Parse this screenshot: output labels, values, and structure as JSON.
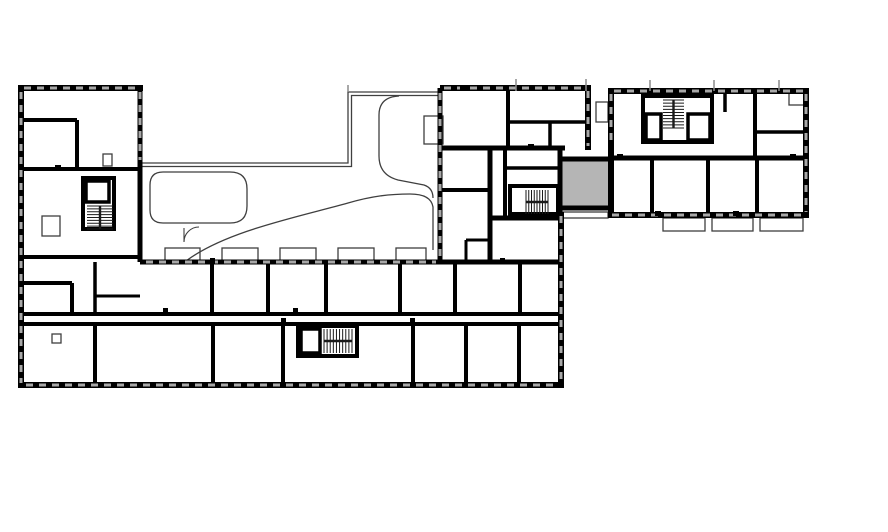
{
  "plan": {
    "canvas": {
      "w": 888,
      "h": 532
    },
    "background": "#ffffff",
    "colors": {
      "wall": "#000000",
      "thin": "#3f3f3f",
      "window": "#a8a8a8",
      "highlight_fill": "#b5b5b5",
      "tread": "#1a1a1a",
      "tick": "#8a8a8a"
    },
    "highlight": {
      "name": "selected-unit",
      "x": 562,
      "y": 161,
      "w": 47,
      "h": 46
    },
    "walls": [
      [
        18,
        88,
        143,
        88,
        6
      ],
      [
        21,
        85,
        21,
        388,
        6
      ],
      [
        18,
        385,
        564,
        385,
        6
      ],
      [
        561,
        212,
        561,
        385,
        6
      ],
      [
        140,
        88,
        140,
        262,
        5
      ],
      [
        440,
        88,
        591,
        88,
        6
      ],
      [
        440,
        88,
        440,
        264,
        5
      ],
      [
        588,
        88,
        588,
        150,
        6
      ],
      [
        440,
        148,
        565,
        148,
        5
      ],
      [
        560,
        148,
        560,
        214,
        5
      ],
      [
        558,
        159,
        614,
        159,
        5
      ],
      [
        560,
        208,
        614,
        208,
        5
      ],
      [
        488,
        218,
        562,
        218,
        5
      ],
      [
        490,
        148,
        490,
        264,
        5
      ],
      [
        611,
        91,
        809,
        91,
        6
      ],
      [
        806,
        88,
        806,
        218,
        6
      ],
      [
        608,
        215,
        809,
        215,
        6
      ],
      [
        611,
        88,
        611,
        218,
        6
      ],
      [
        140,
        262,
        561,
        262,
        5
      ],
      [
        18,
        314,
        561,
        314,
        4
      ],
      [
        18,
        324,
        561,
        324,
        4
      ],
      [
        20,
        120,
        77,
        120,
        4
      ],
      [
        77,
        120,
        77,
        171,
        4
      ],
      [
        20,
        169,
        142,
        169,
        4
      ],
      [
        20,
        257,
        142,
        257,
        4
      ],
      [
        20,
        283,
        72,
        283,
        4
      ],
      [
        72,
        283,
        72,
        316,
        4
      ],
      [
        508,
        88,
        508,
        148,
        4
      ],
      [
        508,
        122,
        588,
        122,
        3.5
      ],
      [
        550,
        122,
        550,
        148,
        3.5
      ],
      [
        440,
        190,
        490,
        190,
        4
      ],
      [
        466,
        240,
        490,
        240,
        3
      ],
      [
        466,
        240,
        466,
        262,
        3
      ],
      [
        505,
        148,
        505,
        220,
        4
      ],
      [
        505,
        168,
        560,
        168,
        3.5
      ],
      [
        95,
        262,
        95,
        316,
        3.5
      ],
      [
        95,
        296,
        140,
        296,
        3
      ],
      [
        212,
        262,
        212,
        314,
        4
      ],
      [
        268,
        262,
        268,
        314,
        4
      ],
      [
        326,
        262,
        326,
        314,
        4
      ],
      [
        400,
        262,
        400,
        314,
        4
      ],
      [
        455,
        262,
        455,
        314,
        4
      ],
      [
        520,
        262,
        520,
        314,
        4
      ],
      [
        95,
        324,
        95,
        385,
        4
      ],
      [
        213,
        324,
        213,
        385,
        4
      ],
      [
        283,
        324,
        283,
        385,
        4
      ],
      [
        413,
        324,
        413,
        385,
        4
      ],
      [
        466,
        324,
        466,
        385,
        4
      ],
      [
        519,
        324,
        519,
        385,
        4
      ],
      [
        611,
        158,
        806,
        158,
        5
      ],
      [
        755,
        91,
        755,
        158,
        4
      ],
      [
        755,
        132,
        806,
        132,
        3.5
      ],
      [
        725,
        91,
        725,
        112,
        3.5
      ],
      [
        652,
        158,
        652,
        215,
        4
      ],
      [
        708,
        158,
        708,
        215,
        4
      ],
      [
        757,
        158,
        757,
        215,
        4
      ]
    ],
    "cores": [
      [
        83,
        178,
        31,
        51
      ],
      [
        298,
        326,
        59,
        30
      ],
      [
        510,
        186,
        48,
        28
      ],
      [
        643,
        96,
        69,
        46
      ]
    ],
    "elevators": [
      [
        86,
        181,
        23,
        21
      ],
      [
        301,
        329,
        19,
        24
      ],
      [
        646,
        114,
        15,
        26
      ],
      [
        688,
        114,
        22,
        26
      ]
    ],
    "stairs": [
      {
        "x": 87,
        "y": 206,
        "w": 26,
        "h": 23,
        "dir": "v",
        "treads": 8
      },
      {
        "x": 324,
        "y": 329,
        "w": 28,
        "h": 24,
        "dir": "h",
        "treads": 9
      },
      {
        "x": 526,
        "y": 190,
        "w": 22,
        "h": 24,
        "dir": "h",
        "treads": 8
      },
      {
        "x": 663,
        "y": 100,
        "w": 21,
        "h": 28,
        "dir": "v",
        "treads": 9
      }
    ],
    "thin_rects": [
      [
        165,
        248,
        35,
        14
      ],
      [
        222,
        248,
        36,
        14
      ],
      [
        280,
        248,
        36,
        14
      ],
      [
        338,
        248,
        36,
        14
      ],
      [
        396,
        248,
        30,
        14
      ],
      [
        663,
        218,
        42,
        13
      ],
      [
        712,
        218,
        41,
        13
      ],
      [
        760,
        218,
        43,
        13
      ],
      [
        563,
        212,
        45,
        6
      ],
      [
        424,
        116,
        19,
        28
      ],
      [
        596,
        102,
        12,
        20
      ],
      [
        789,
        93,
        17,
        12
      ],
      [
        42,
        216,
        18,
        20
      ],
      [
        103,
        154,
        9,
        12
      ],
      [
        52,
        334,
        9,
        9
      ]
    ],
    "thin_paths": [
      "M140,163 L348,163 L348,92 L440,92",
      "M140,166.5 L351.5,166.5 L351.5,95.5 L440,95.5",
      "M163,172 H230 Q247,172 247,189 V206 Q247,223 230,223 H163 Q150,223 150,210 V185 Q150,172 163,172 Z",
      "M186,261 C226,231 298,217 348,203 C372,196 390,194 410,194 Q431,194 433,207 L433,250",
      "M399,96 Q379,97 379,115 L379,156 Q379,175 398,180 L424,185 Q433,188 433,198"
    ],
    "door_arcs": [
      "M184,242 A15,15 0 0 1 199,227 M184,242 L184,228"
    ],
    "window_runs": [
      [
        21,
        92,
        21,
        383
      ],
      [
        26,
        385,
        558,
        385
      ],
      [
        561,
        216,
        561,
        382
      ],
      [
        24,
        88,
        136,
        88
      ],
      [
        140,
        92,
        140,
        160
      ],
      [
        444,
        88,
        584,
        88
      ],
      [
        588,
        91,
        588,
        146
      ],
      [
        440,
        93,
        440,
        258
      ],
      [
        146,
        262,
        436,
        262
      ],
      [
        614,
        91,
        803,
        91
      ],
      [
        806,
        94,
        806,
        212
      ],
      [
        612,
        215,
        803,
        215
      ],
      [
        611,
        94,
        611,
        146
      ]
    ],
    "roof_ticks": [
      [
        516,
        79,
        91
      ],
      [
        586,
        79,
        91
      ],
      [
        650,
        80,
        91
      ],
      [
        714,
        80,
        91
      ],
      [
        779,
        80,
        91
      ],
      [
        348,
        85,
        92
      ]
    ],
    "nibs": [
      [
        163,
        308,
        5,
        7
      ],
      [
        293,
        308,
        5,
        7
      ],
      [
        55,
        165,
        6,
        5
      ],
      [
        210,
        258,
        5,
        6
      ],
      [
        281,
        318,
        5,
        7
      ],
      [
        410,
        318,
        5,
        7
      ],
      [
        500,
        258,
        5,
        6
      ],
      [
        655,
        211,
        6,
        5
      ],
      [
        733,
        211,
        6,
        5
      ],
      [
        790,
        154,
        6,
        5
      ],
      [
        617,
        154,
        6,
        5
      ],
      [
        528,
        144,
        6,
        5
      ],
      [
        460,
        86,
        6,
        5
      ]
    ]
  }
}
